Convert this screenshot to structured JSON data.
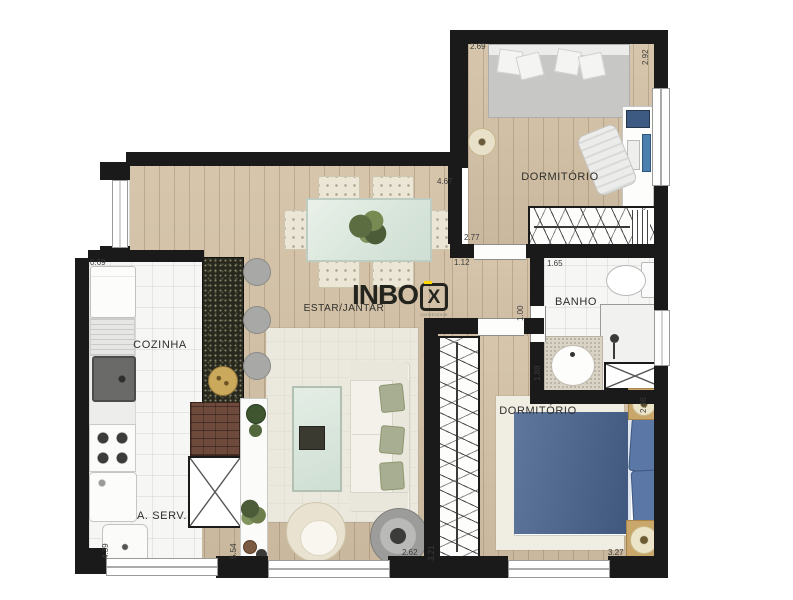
{
  "logo": {
    "main": "INBO",
    "boxed_letter": "X",
    "tagline": "construtora"
  },
  "rooms": {
    "bedroom1": "DORMITÓRIO",
    "bedroom2": "DORMITÓRIO",
    "bathroom": "BANHO",
    "kitchen": "COZINHA",
    "service": "A. SERV.",
    "living": "ESTAR/JANTAR"
  },
  "measurements": {
    "kitchen_niche": "0.69",
    "bedroom1_width": "2.69",
    "bedroom1_depth": "2.92",
    "living_width": "4.67",
    "hall_wall": "2.77",
    "bedroom1_door": "1.12",
    "bath_width": "1.65",
    "bath_door": "1.00",
    "bath_counter": "1.88",
    "bedroom2_nook": "2.46",
    "service_depth": "4.39",
    "living_depth": "5.54",
    "living_bottom": "2.62",
    "closet_depth": "3.21",
    "bedroom2_width": "3.27"
  },
  "colors": {
    "wall": "#1a1a1a",
    "wood_floor": "#d4c2a6",
    "granite": "#29281e",
    "bed_blue": "#49648f",
    "glass_green": "#dfe9e1",
    "logo_yellow": "#ffd900"
  }
}
